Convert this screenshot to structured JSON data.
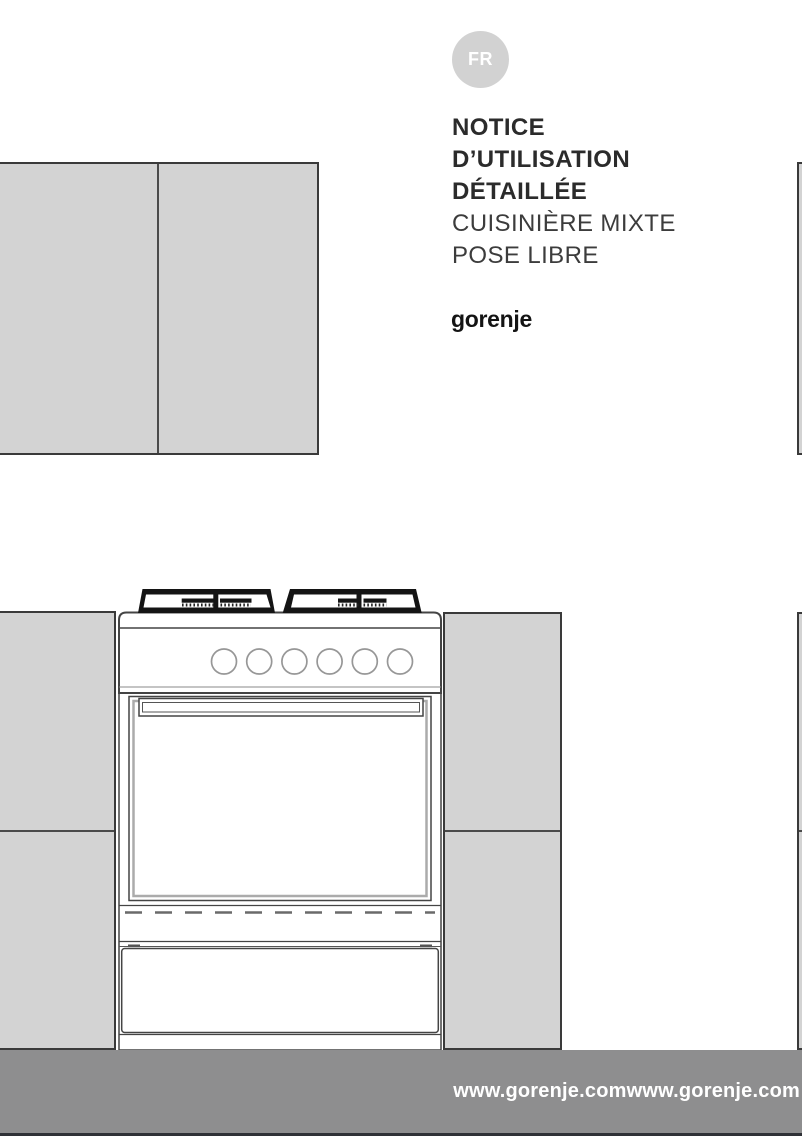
{
  "page": {
    "language_badge": "FR",
    "title_line1": "NOTICE",
    "title_line2": "D’UTILISATION",
    "title_line3": "DÉTAILLÉE",
    "subtitle_line1": "CUISINIÈRE MIXTE",
    "subtitle_line2": "POSE LIBRE",
    "brand_logo": "gorenje",
    "footer_url": "www.gorenje.comwww.gorenje.com"
  },
  "colors": {
    "badge_bg": "#d2d2d2",
    "badge_text": "#ffffff",
    "title_text": "#2b2b2b",
    "subtitle_text": "#3c3c3c",
    "cabinet_fill": "#d3d3d3",
    "cabinet_border": "#3a3a3a",
    "line_art": "#444444",
    "footer_bg": "#8e8e8f",
    "footer_text": "#ffffff",
    "footer_bottom_edge": "#2f3136"
  },
  "illustration": {
    "type": "line-drawing",
    "subject": "freestanding mixed cooker installed between kitchen cabinets",
    "hob_pan_supports": 2,
    "control_knob_count": 6,
    "parts": [
      "gas-hob-pan-supports",
      "burner-caps",
      "control-panel",
      "control-knobs",
      "oven-door",
      "oven-door-handle",
      "storage-drawer"
    ]
  }
}
